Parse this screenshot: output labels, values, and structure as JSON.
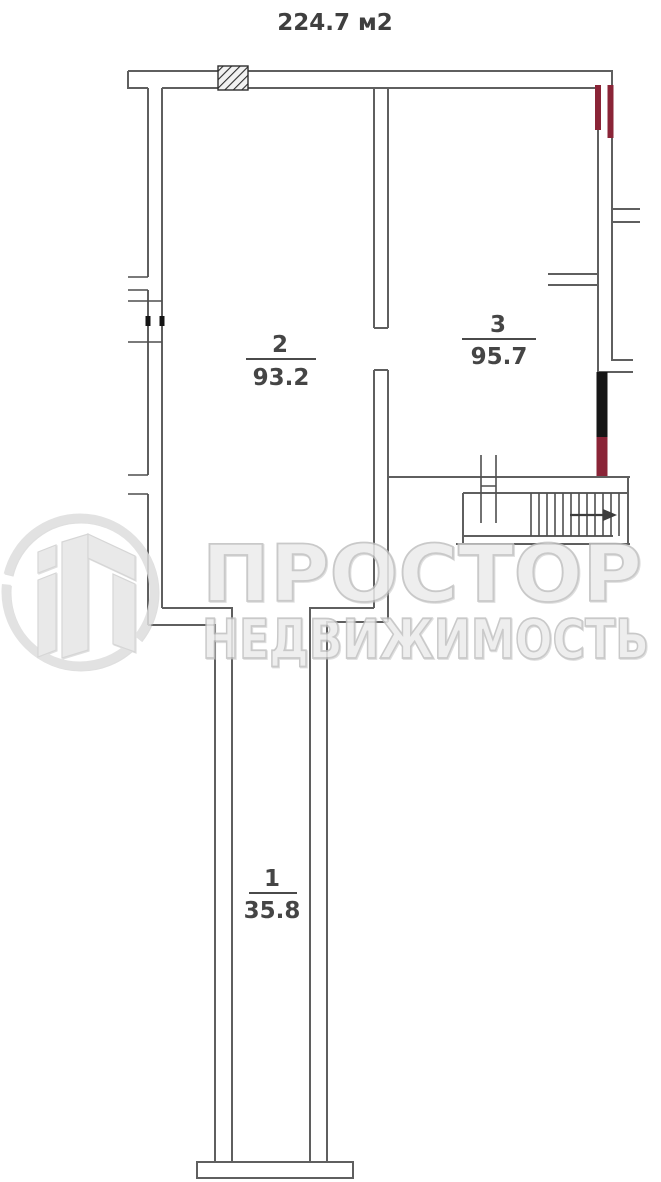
{
  "title": "224.7 м2",
  "rooms": {
    "room1": {
      "number": "1",
      "area": "35.8"
    },
    "room2": {
      "number": "2",
      "area": "93.2"
    },
    "room3": {
      "number": "3",
      "area": "95.7"
    }
  },
  "watermark": {
    "brand": "ПРОСТОР",
    "brand_sub": "НЕДВИЖИМОСТЬ"
  },
  "colors": {
    "wall": "#5f5f5f",
    "marker_red": "#8a2437",
    "marker_black": "#161616",
    "watermark_gray": "#e6e6e6",
    "label_text": "#454545"
  }
}
